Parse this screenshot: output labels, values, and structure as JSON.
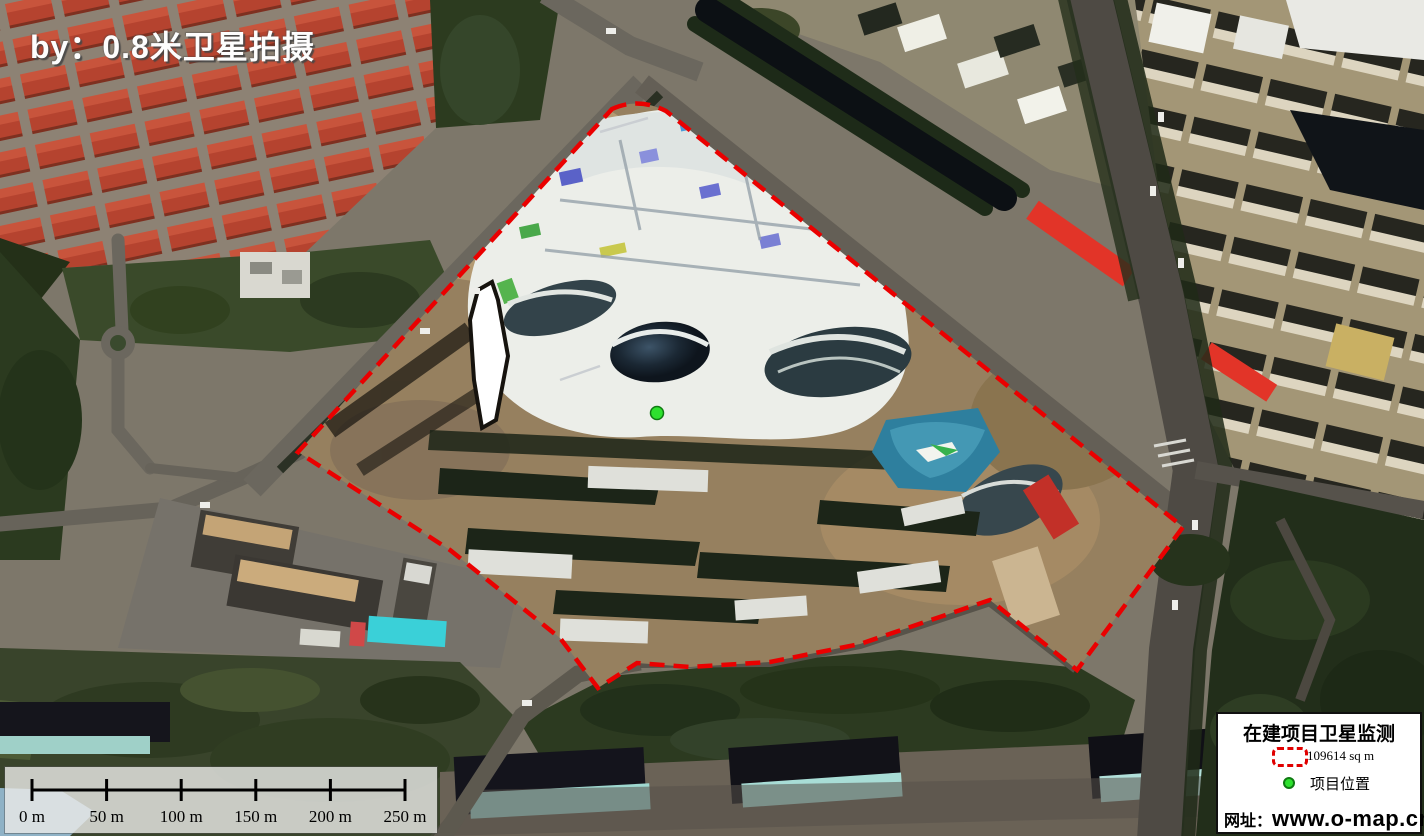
{
  "overlay": {
    "credit": "by：0.8米卫星拍摄"
  },
  "scale_bar": {
    "labels": [
      "0 m",
      "50 m",
      "100 m",
      "150 m",
      "200 m",
      "250 m"
    ]
  },
  "legend": {
    "title": "在建项目卫星监测",
    "area_label": "109614 sq m",
    "location_label": "项目位置",
    "website_word": "网址：",
    "website_url": "www.o-map.cn"
  },
  "annotations": {
    "boundary_color": "#ea0000",
    "marker_color": "#2ee12e",
    "icons": [
      "dashed-boundary-icon",
      "location-dot-icon"
    ]
  }
}
